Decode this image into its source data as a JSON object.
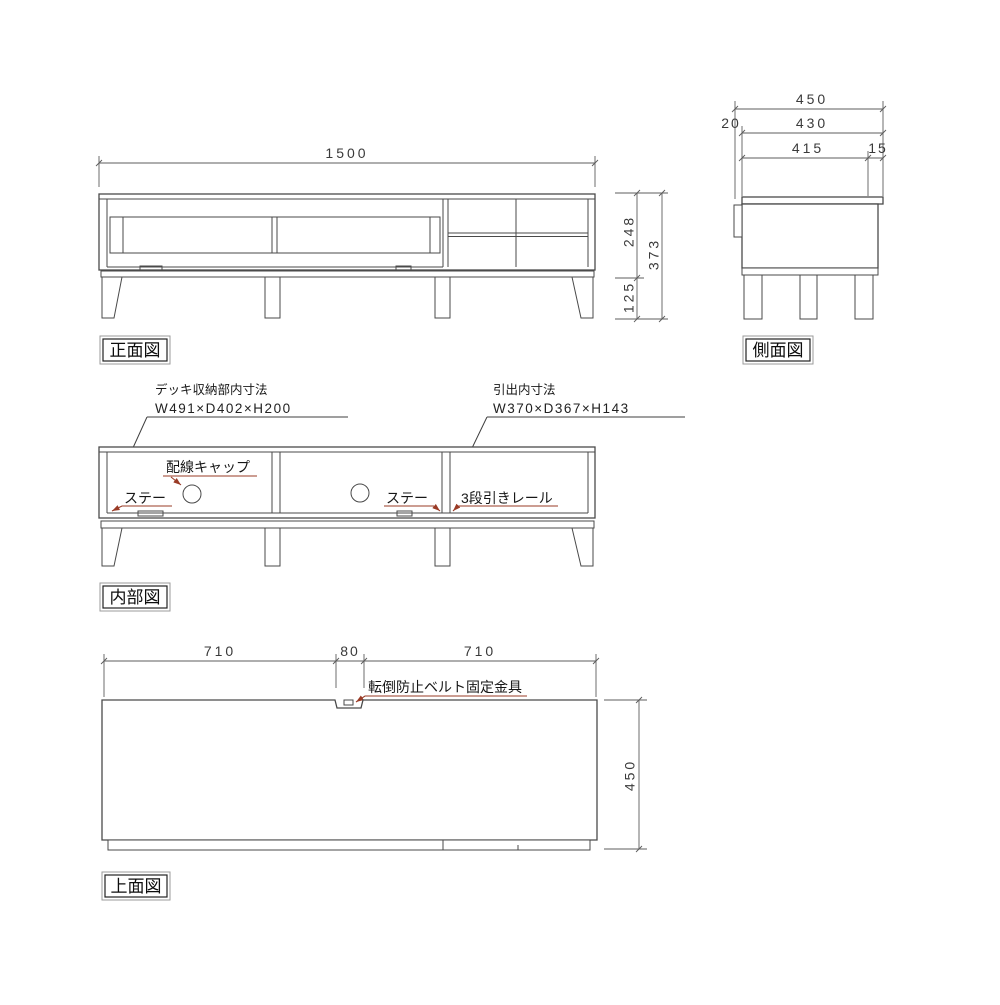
{
  "colors": {
    "line": "#4a4a4a",
    "text": "#171717",
    "dimension_text": "#3a3a3a",
    "annotation_red": "#9a3b26",
    "background": "#ffffff"
  },
  "front_view": {
    "label": "正面図",
    "dim_width": "1500",
    "dim_body_height": "248",
    "dim_leg_height": "125",
    "dim_total_height": "373"
  },
  "side_view": {
    "label": "側面図",
    "dim_total_depth": "450",
    "dim_back_offset": "20",
    "dim_body_depth": "430",
    "dim_inner_depth": "415",
    "dim_front_edge": "15"
  },
  "internal_view": {
    "label": "内部図",
    "deck_title": "デッキ収納部内寸法",
    "deck_size": "W491×D402×H200",
    "drawer_title": "引出内寸法",
    "drawer_size": "W370×D367×H143",
    "cable_cap": "配線キャップ",
    "stay_left": "ステー",
    "stay_right": "ステー",
    "slide_rail": "3段引きレール"
  },
  "top_view": {
    "label": "上面図",
    "dim_left": "710",
    "dim_center": "80",
    "dim_right": "710",
    "dim_depth": "450",
    "belt_bracket": "転倒防止ベルト固定金具"
  }
}
